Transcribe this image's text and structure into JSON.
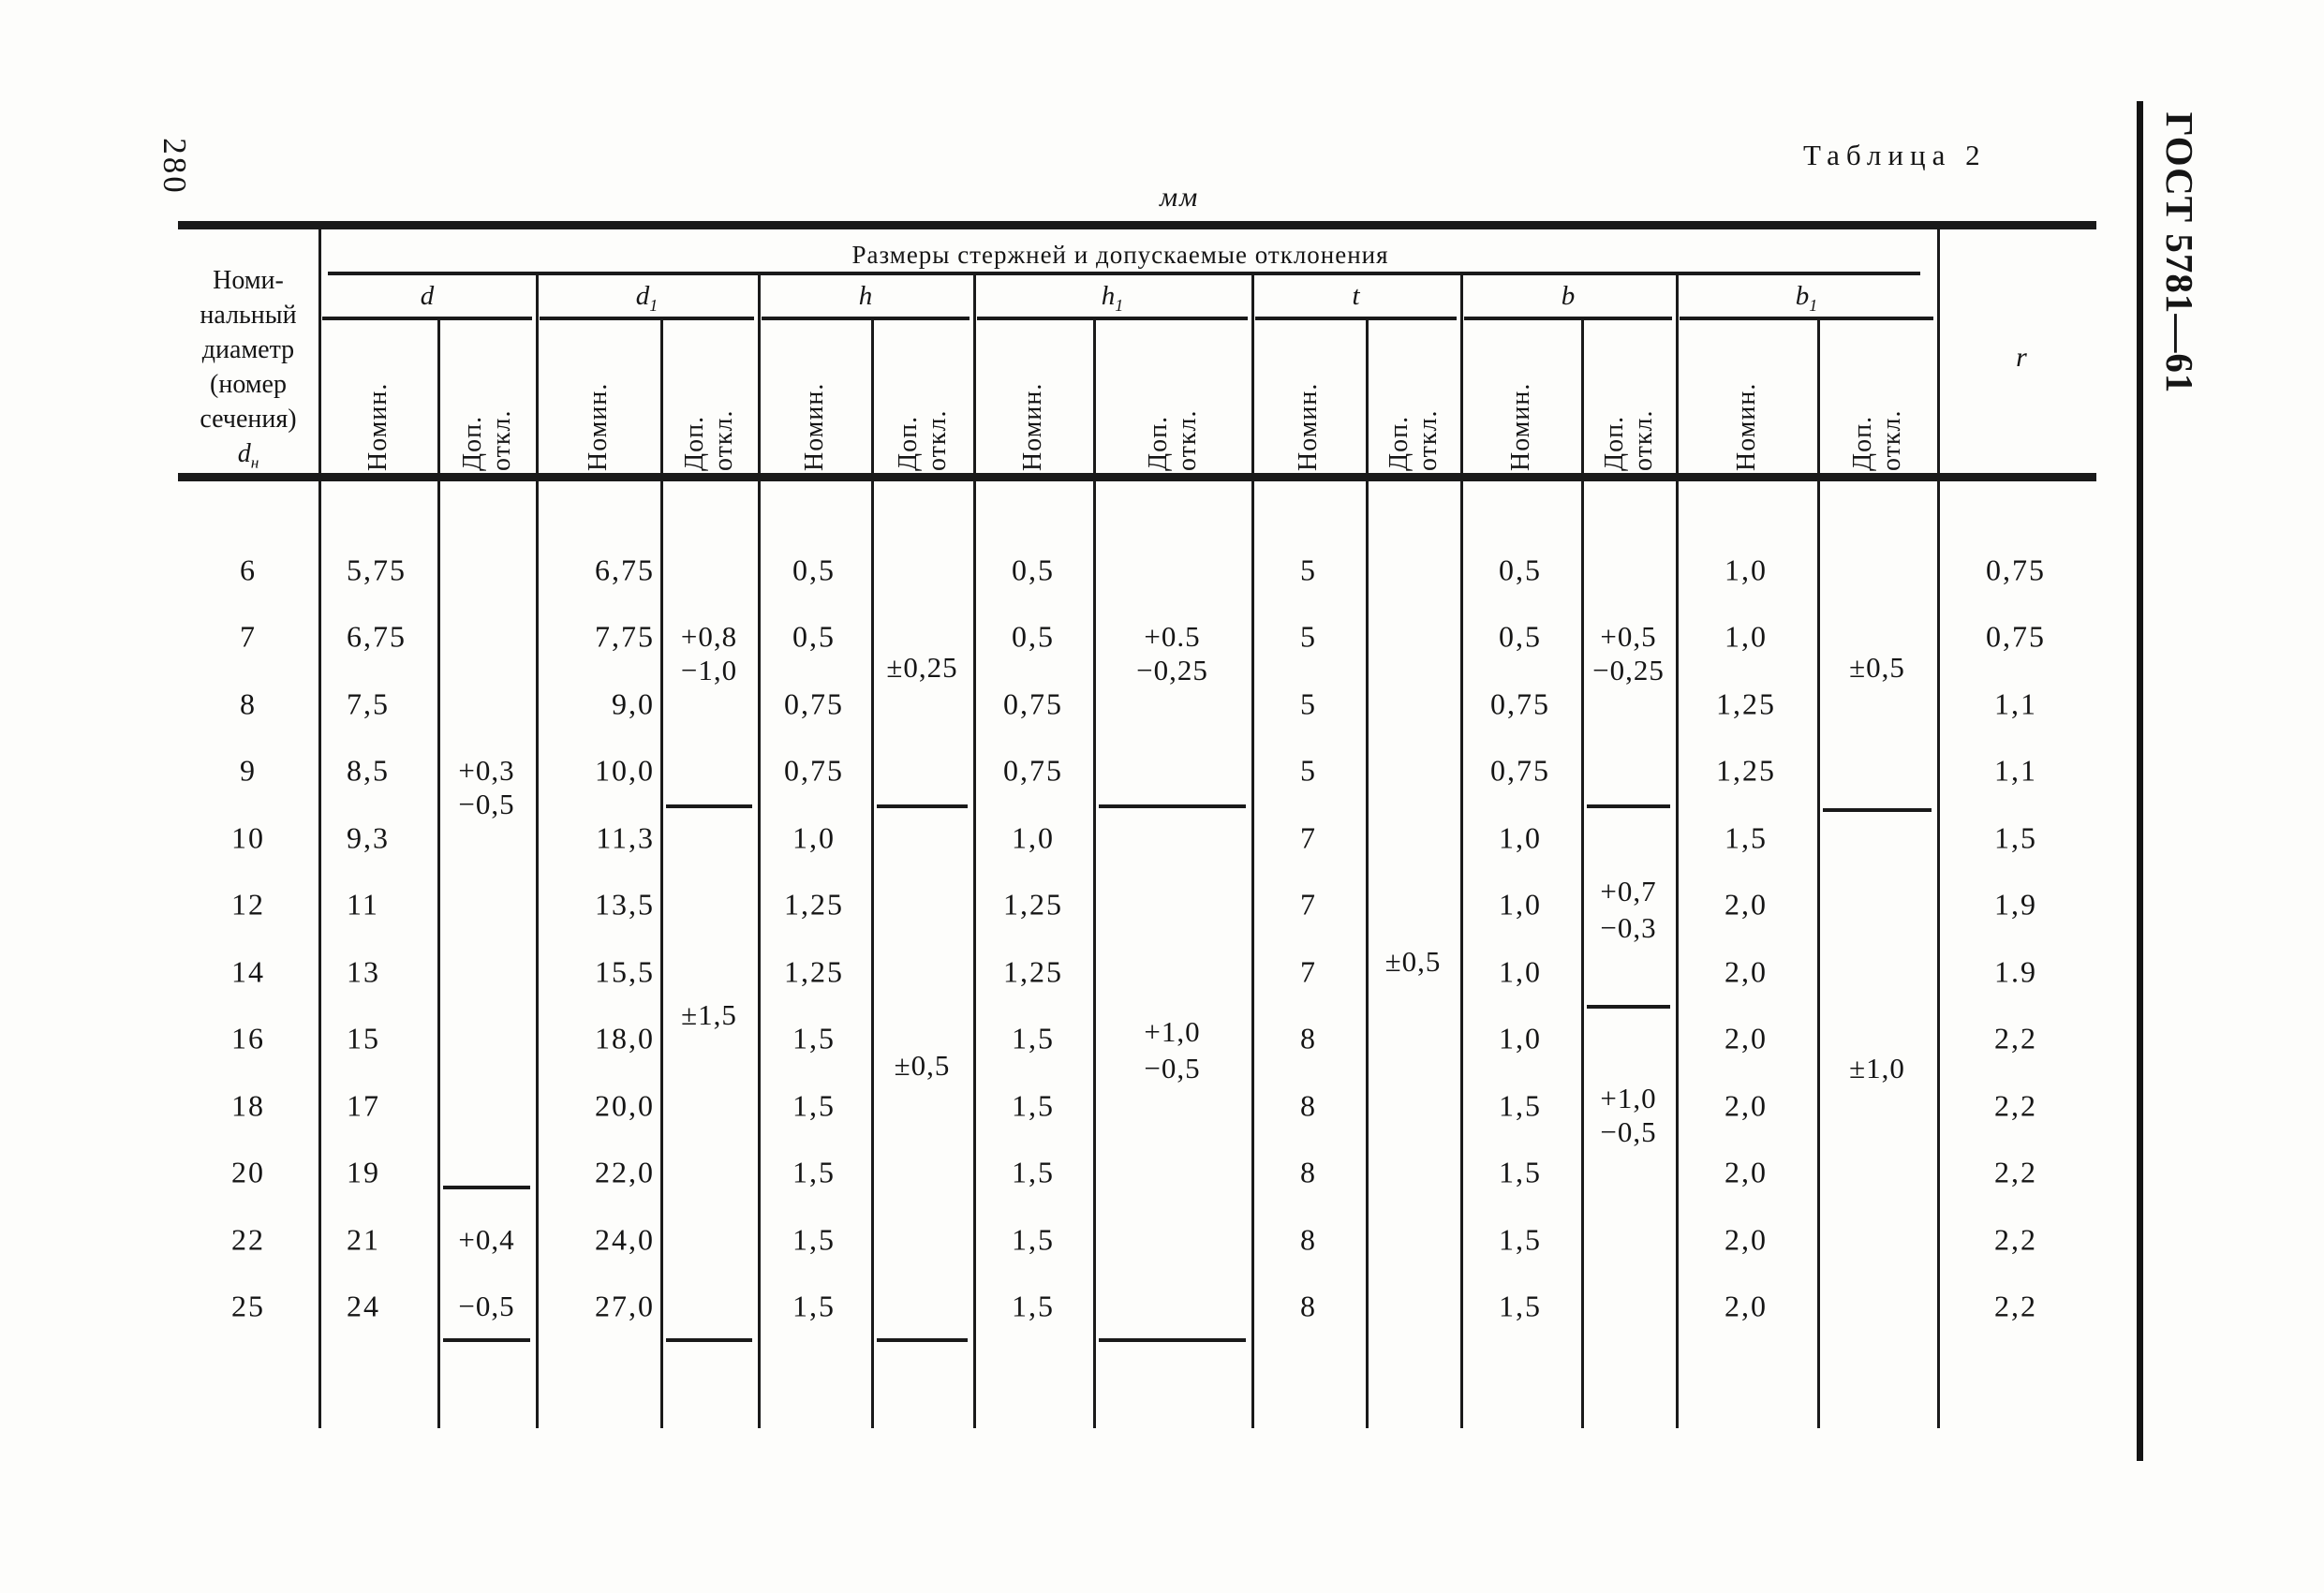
{
  "page": {
    "page_number": "280",
    "caption": "Таблица 2",
    "units": "мм",
    "standard": "ГОСТ 5781—61"
  },
  "table": {
    "span_header": "Размеры стержней и допускаемые отклонения",
    "row_header": {
      "lines": [
        "Номи-",
        "нальный",
        "диаметр",
        "(номер",
        "сечения)"
      ],
      "symbol": "d",
      "symbol_sub": "н"
    },
    "subheaders": {
      "nominal": "Номин.",
      "tolerance": "Доп.\nоткл."
    },
    "r_header": "r",
    "groups": [
      {
        "id": "d",
        "symbol": "d",
        "sub": ""
      },
      {
        "id": "d1",
        "symbol": "d",
        "sub": "1"
      },
      {
        "id": "h",
        "symbol": "h",
        "sub": ""
      },
      {
        "id": "h1",
        "symbol": "h",
        "sub": "1"
      },
      {
        "id": "t",
        "symbol": "t",
        "sub": ""
      },
      {
        "id": "b",
        "symbol": "b",
        "sub": ""
      },
      {
        "id": "b1",
        "symbol": "b",
        "sub": "1"
      }
    ],
    "rows": [
      {
        "dn": "6",
        "d": "5,75",
        "d1": "6,75",
        "h": "0,5",
        "h1": "0,5",
        "t": "5",
        "b": "0,5",
        "b1": "1,0",
        "r": "0,75"
      },
      {
        "dn": "7",
        "d": "6,75",
        "d1": "7,75",
        "h": "0,5",
        "h1": "0,5",
        "t": "5",
        "b": "0,5",
        "b1": "1,0",
        "r": "0,75"
      },
      {
        "dn": "8",
        "d": "7,5",
        "d1": "9,0",
        "h": "0,75",
        "h1": "0,75",
        "t": "5",
        "b": "0,75",
        "b1": "1,25",
        "r": "1,1"
      },
      {
        "dn": "9",
        "d": "8,5",
        "d1": "10,0",
        "h": "0,75",
        "h1": "0,75",
        "t": "5",
        "b": "0,75",
        "b1": "1,25",
        "r": "1,1"
      },
      {
        "dn": "10",
        "d": "9,3",
        "d1": "11,3",
        "h": "1,0",
        "h1": "1,0",
        "t": "7",
        "b": "1,0",
        "b1": "1,5",
        "r": "1,5"
      },
      {
        "dn": "12",
        "d": "11",
        "d1": "13,5",
        "h": "1,25",
        "h1": "1,25",
        "t": "7",
        "b": "1,0",
        "b1": "2,0",
        "r": "1,9"
      },
      {
        "dn": "14",
        "d": "13",
        "d1": "15,5",
        "h": "1,25",
        "h1": "1,25",
        "t": "7",
        "b": "1,0",
        "b1": "2,0",
        "r": "1.9"
      },
      {
        "dn": "16",
        "d": "15",
        "d1": "18,0",
        "h": "1,5",
        "h1": "1,5",
        "t": "8",
        "b": "1,0",
        "b1": "2,0",
        "r": "2,2"
      },
      {
        "dn": "18",
        "d": "17",
        "d1": "20,0",
        "h": "1,5",
        "h1": "1,5",
        "t": "8",
        "b": "1,5",
        "b1": "2,0",
        "r": "2,2"
      },
      {
        "dn": "20",
        "d": "19",
        "d1": "22,0",
        "h": "1,5",
        "h1": "1,5",
        "t": "8",
        "b": "1,5",
        "b1": "2,0",
        "r": "2,2"
      },
      {
        "dn": "22",
        "d": "21",
        "d1": "24,0",
        "h": "1,5",
        "h1": "1,5",
        "t": "8",
        "b": "1,5",
        "b1": "2,0",
        "r": "2,2"
      },
      {
        "dn": "25",
        "d": "24",
        "d1": "27,0",
        "h": "1,5",
        "h1": "1,5",
        "t": "8",
        "b": "1,5",
        "b1": "2,0",
        "r": "2,2"
      }
    ],
    "tolerances": {
      "d": {
        "items": [
          {
            "text": "+0,3",
            "row": 3
          },
          {
            "text": "−0,5",
            "row": 3.5
          },
          {
            "text": "+0,4",
            "row": 10
          },
          {
            "text": "−0,5",
            "row": 11
          }
        ],
        "separators": [
          9.2
        ],
        "bottom_line": true
      },
      "d1": {
        "items": [
          {
            "text": "+0,8",
            "row": 1
          },
          {
            "text": "−1,0",
            "row": 1.5
          },
          {
            "text": "±1,5",
            "row": 6.65
          }
        ],
        "separators": [
          3.5
        ],
        "bottom_line": true
      },
      "h": {
        "items": [
          {
            "text": "±0,25",
            "row": 1.45
          },
          {
            "text": "±0,5",
            "row": 7.4
          }
        ],
        "separators": [
          3.5
        ],
        "bottom_line": true
      },
      "h1": {
        "items": [
          {
            "text": "+0.5",
            "row": 1
          },
          {
            "text": "−0,25",
            "row": 1.5
          },
          {
            "text": "+1,0",
            "row": 6.9
          },
          {
            "text": "−0,5",
            "row": 7.45
          }
        ],
        "separators": [
          3.5
        ],
        "bottom_line": true
      },
      "t": {
        "items": [
          {
            "text": "±0,5",
            "row": 5.85
          }
        ],
        "separators": [],
        "bottom_line": false
      },
      "b": {
        "items": [
          {
            "text": "+0,5",
            "row": 1
          },
          {
            "text": "−0,25",
            "row": 1.5
          },
          {
            "text": "+0,7",
            "row": 4.8
          },
          {
            "text": "−0,3",
            "row": 5.35
          },
          {
            "text": "+1,0",
            "row": 7.9
          },
          {
            "text": "−0,5",
            "row": 8.4
          }
        ],
        "separators": [
          3.5,
          6.5
        ],
        "bottom_line": false
      },
      "b1": {
        "items": [
          {
            "text": "±0,5",
            "row": 1.45
          },
          {
            "text": "±1,0",
            "row": 7.45
          }
        ],
        "separators": [
          3.55
        ],
        "bottom_line": false
      }
    }
  }
}
